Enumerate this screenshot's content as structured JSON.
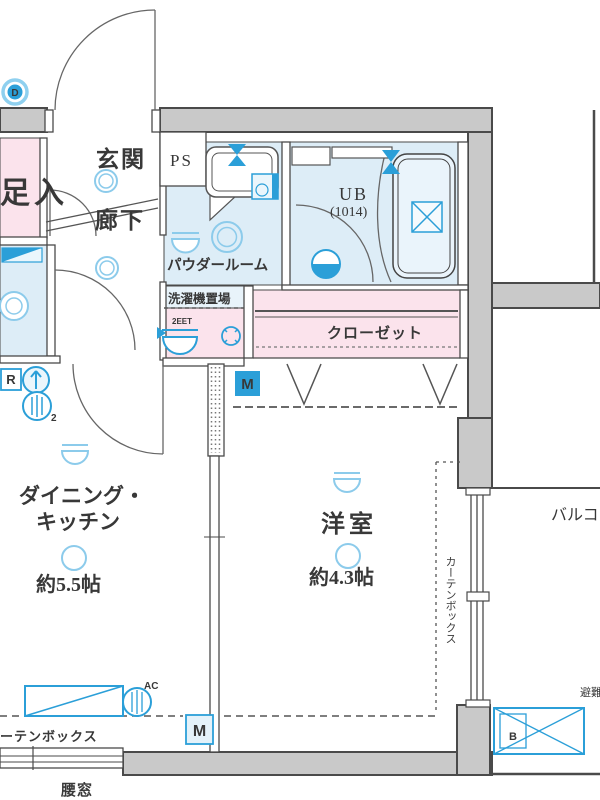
{
  "rooms": {
    "genkan": "玄関",
    "hallway": "廊下",
    "shoe_storage": "下足入",
    "pipe_space": "PS",
    "powder_room": "パウダールーム",
    "laundry": "洗濯機置場",
    "laundry_pan_code": "2EET",
    "unit_bath": "UB",
    "unit_bath_size": "(1014)",
    "closet": "クローゼット",
    "dk_line1": "ダイニング・",
    "dk_line2": "キッチン",
    "dk_area": "約5.5帖",
    "western_room": "洋室",
    "western_area": "約4.3帖",
    "balcony": "バルコニー",
    "waist_window": "腰窓",
    "curtain_box_side": "カーテンボックス",
    "curtain_box_bottom": "カーテンボックス",
    "evacuation_hatch": "避難ハッチ"
  },
  "badges": {
    "door_d": "D",
    "meter_m_closet": "M",
    "meter_m_bottom": "M",
    "meter_r": "R",
    "hatch_b": "B",
    "ac": "AC",
    "meter_sub": "2"
  },
  "colors": {
    "wall": "#c9c9c9",
    "line": "#4a4a4a",
    "room_pink": "#fbe3ec",
    "room_blue": "#ddedf7",
    "fixture_blue": "#2b9fd8",
    "light_blue": "#8ccbeb"
  }
}
